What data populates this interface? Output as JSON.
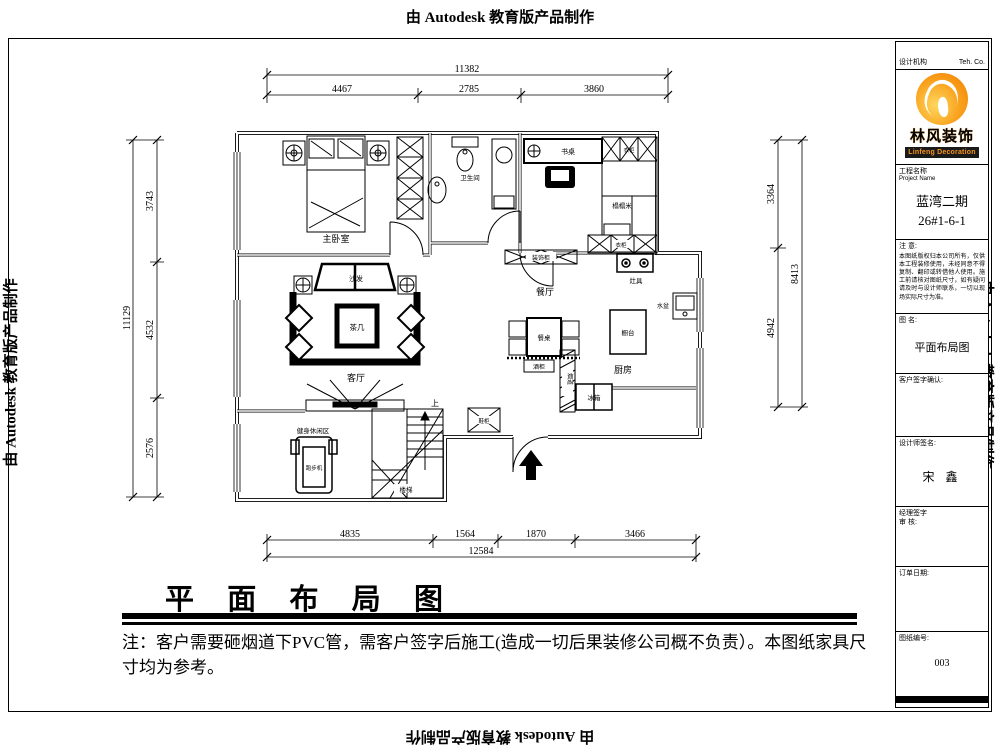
{
  "watermark": {
    "text": "由 Autodesk 教育版产品制作"
  },
  "title_block": {
    "header": {
      "left": "设计机构",
      "right": "Teh.  Co."
    },
    "logo": {
      "cn": "林风装饰",
      "en": "Linfeng Decoration",
      "accent": "#f7941d"
    },
    "project": {
      "label_cn": "工程名称",
      "label_en": "Project  Name",
      "name_line1": "蓝湾二期",
      "name_line2": "26#1-6-1"
    },
    "notice": {
      "heading": "注 意:",
      "body": "本图纸版权归本公司所有，仅供本工程装修使用，未经同意不得复制、翻印或转借他人使用。施工前请核对图纸尺寸，如有疑问请及时与设计师联系，一切以现场实际尺寸为准。"
    },
    "drawing_name": {
      "label": "图 名:",
      "value": "平面布局图"
    },
    "customer": {
      "label": "客户签字确认:"
    },
    "designer": {
      "label": "设计师签名:",
      "value": "宋 鑫"
    },
    "manager": {
      "line1": "经理签字",
      "line2": "审 核:"
    },
    "order": {
      "label": "订单日期:"
    },
    "sheet": {
      "label": "图纸编号:",
      "value": "003"
    }
  },
  "plan": {
    "labels": {
      "master_bedroom": "主卧室",
      "bathroom": "卫生间",
      "desk": "书桌",
      "wardrobe_top": "衣柜",
      "tatami": "榻榻米",
      "wardrobe_bottom": "衣柜",
      "sofa": "沙发",
      "tea_table": "茶几",
      "living_room": "客厅",
      "dining_room": "餐厅",
      "dining_table": "餐桌",
      "side_cabinet": "装饰柜",
      "wine_cabinet": "酒柜",
      "stove": "灶具",
      "counter": "橱台",
      "basin": "水盆",
      "kitchen": "厨房",
      "flue": "烟道",
      "fridge": "冰箱",
      "fitness": "健身休闲区",
      "treadmill": "跑步机",
      "stairs": "楼梯",
      "up": "上",
      "shoe_cabinet": "鞋柜"
    }
  },
  "dims": {
    "top": {
      "total": "11382",
      "segs": [
        "4467",
        "2785",
        "3860"
      ]
    },
    "left": {
      "total": "11129",
      "segs": [
        "3743",
        "4532",
        "2576"
      ]
    },
    "right": {
      "total": "8413",
      "segs": [
        "3364",
        "4942"
      ]
    },
    "bottom": {
      "total": "12584",
      "segs": [
        "4835",
        "1564",
        "1870",
        "3466"
      ]
    }
  },
  "footer": {
    "title": "平 面 布 局 图",
    "note": "注：客户需要砸烟道下PVC管，需客户签字后施工(造成一切后果装修公司概不负责）。本图纸家具尺寸均为参考。"
  }
}
